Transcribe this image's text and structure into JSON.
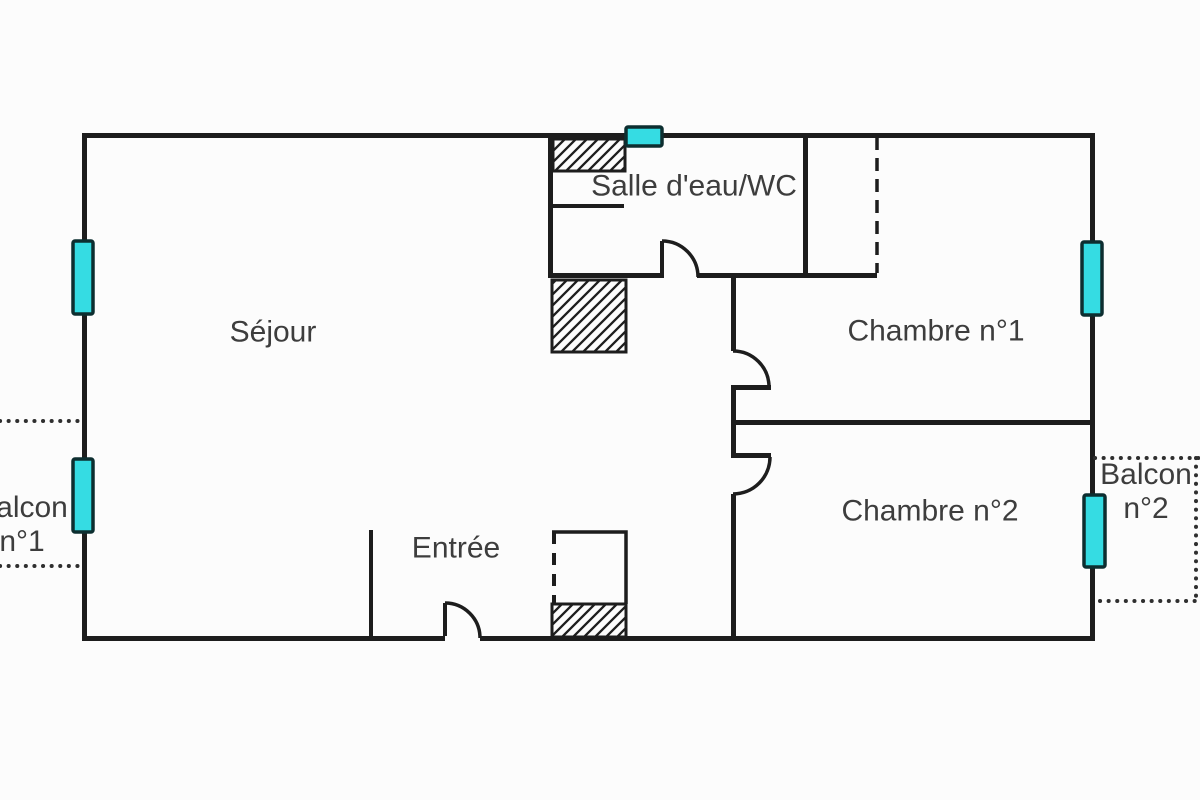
{
  "plan": {
    "rooms": {
      "sejour": {
        "label": "Séjour"
      },
      "salle_eau": {
        "label": "Salle d'eau/WC"
      },
      "chambre1": {
        "label": "Chambre n°1"
      },
      "chambre2": {
        "label": "Chambre n°2"
      },
      "entree": {
        "label": "Entrée"
      },
      "balcon1": {
        "line1": "Balcon",
        "line2": "n°1"
      },
      "balcon2": {
        "line1": "Balcon",
        "line2": "n°2"
      }
    },
    "colors": {
      "wall": "#1d1d1d",
      "text": "#3d3d3d",
      "window_fill": "#35dce3",
      "window_border": "#0d2e30",
      "dotted_line": "#2f2f2f",
      "background": "#fcfcfc"
    }
  }
}
